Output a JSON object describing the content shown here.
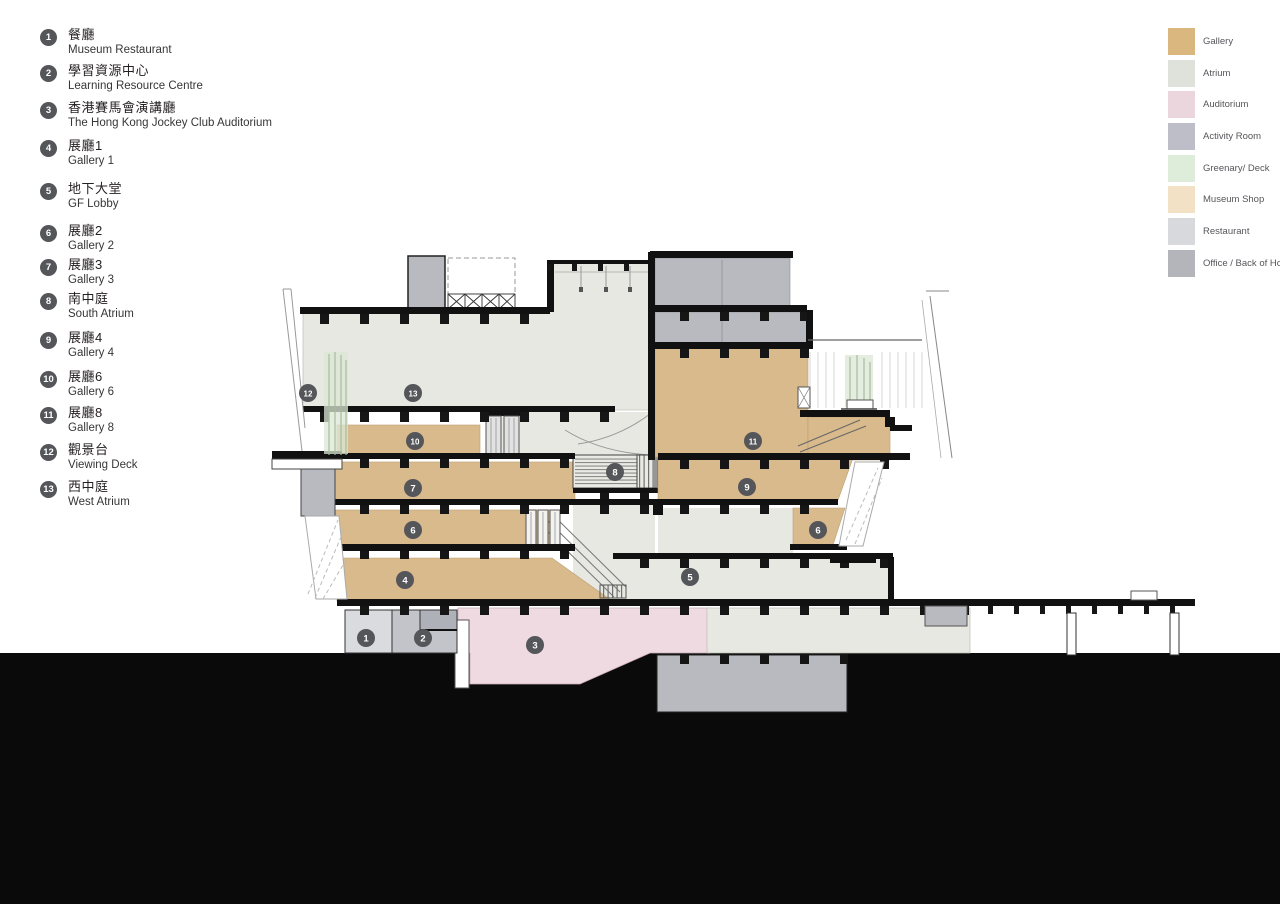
{
  "left_legend": {
    "items": [
      {
        "num": "1",
        "zh": "餐廳",
        "en": "Museum Restaurant"
      },
      {
        "num": "2",
        "zh": "學習資源中心",
        "en": "Learning Resource Centre"
      },
      {
        "num": "3",
        "zh": "香港賽馬會演講廳",
        "en": "The Hong Kong Jockey Club Auditorium"
      },
      {
        "num": "4",
        "zh": "展廳1",
        "en": "Gallery 1"
      },
      {
        "num": "5",
        "zh": "地下大堂",
        "en": "GF Lobby"
      },
      {
        "num": "6",
        "zh": "展廳2",
        "en": "Gallery 2"
      },
      {
        "num": "7",
        "zh": "展廳3",
        "en": "Gallery 3"
      },
      {
        "num": "8",
        "zh": "南中庭",
        "en": "South Atrium"
      },
      {
        "num": "9",
        "zh": "展廳4",
        "en": "Gallery 4"
      },
      {
        "num": "10",
        "zh": "展廳6",
        "en": "Gallery 6"
      },
      {
        "num": "11",
        "zh": "展廳8",
        "en": "Gallery 8"
      },
      {
        "num": "12",
        "zh": "觀景台",
        "en": "Viewing Deck"
      },
      {
        "num": "13",
        "zh": "西中庭",
        "en": "West Atrium"
      }
    ]
  },
  "right_legend": {
    "items": [
      {
        "label": "Gallery",
        "color": "#D9B77F"
      },
      {
        "label": "Atrium",
        "color": "#DFE2DA"
      },
      {
        "label": "Auditorium",
        "color": "#EBD6DD"
      },
      {
        "label": "Activity Room",
        "color": "#BDBEC8"
      },
      {
        "label": "Greenary/ Deck",
        "color": "#DEEDD9"
      },
      {
        "label": "Museum Shop",
        "color": "#F3E1C6"
      },
      {
        "label": "Restaurant",
        "color": "#D7D9DC"
      },
      {
        "label": "Office / Back of House",
        "color": "#B3B5BA"
      }
    ]
  },
  "palette": {
    "gallery": "#D8BA8C",
    "atrium": "#E6E8E1",
    "auditorium": "#EFDAE1",
    "activity": "#C3C4C9",
    "greenery": "#DCE7D6",
    "shop": "#F3E1C6",
    "restaurant": "#D9DBDE",
    "office": "#B9BABF",
    "ground": "#0A0A0A",
    "marker": "#55565A"
  },
  "section": {
    "markers": [
      {
        "label": "1"
      },
      {
        "label": "2"
      },
      {
        "label": "3"
      },
      {
        "label": "4"
      },
      {
        "label": "5"
      },
      {
        "label": "6"
      },
      {
        "label": "6"
      },
      {
        "label": "7"
      },
      {
        "label": "8"
      },
      {
        "label": "9"
      },
      {
        "label": "10"
      },
      {
        "label": "11"
      },
      {
        "label": "12"
      },
      {
        "label": "13"
      }
    ]
  }
}
